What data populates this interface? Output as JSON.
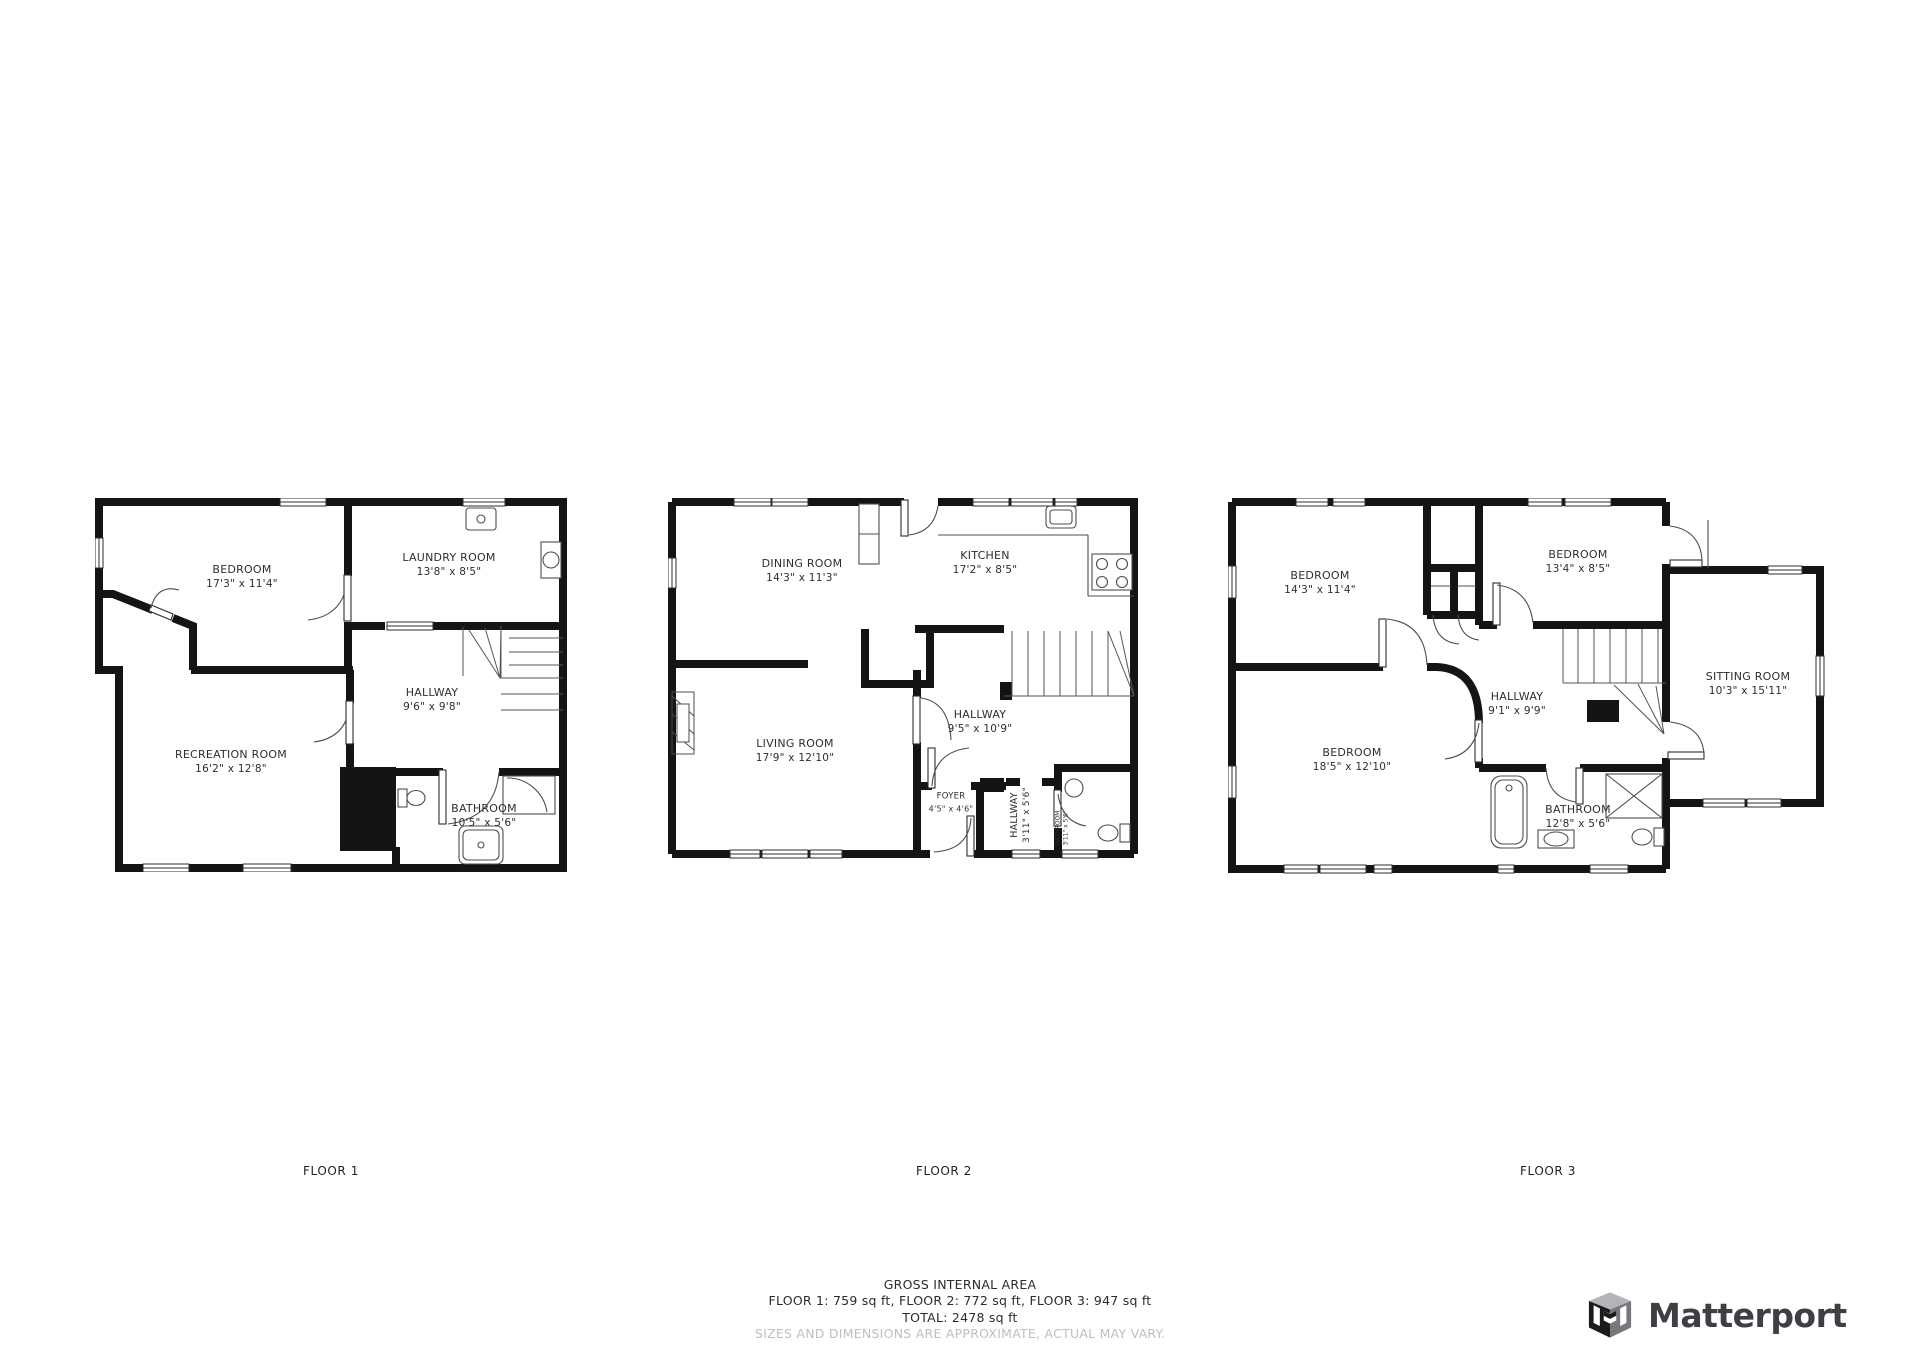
{
  "page": {
    "background": "#ffffff",
    "wall_color": "#141414",
    "label_color": "#2e2e2e",
    "disclaimer_color": "#bfbfbf",
    "brand_color": "#3e3e44"
  },
  "floors": [
    {
      "id": "floor-1",
      "label": "FLOOR 1",
      "caption": {
        "x": 331,
        "y": 1171
      },
      "rooms": [
        {
          "name": "BEDROOM",
          "dims": "17'3\" x 11'4\"",
          "x": 242,
          "y": 577
        },
        {
          "name": "LAUNDRY ROOM",
          "dims": "13'8\" x 8'5\"",
          "x": 449,
          "y": 565
        },
        {
          "name": "HALLWAY",
          "dims": "9'6\" x 9'8\"",
          "x": 432,
          "y": 700
        },
        {
          "name": "RECREATION ROOM",
          "dims": "16'2\" x 12'8\"",
          "x": 231,
          "y": 762
        },
        {
          "name": "BATHROOM",
          "dims": "10'5\" x 5'6\"",
          "x": 484,
          "y": 816
        }
      ]
    },
    {
      "id": "floor-2",
      "label": "FLOOR 2",
      "caption": {
        "x": 944,
        "y": 1171
      },
      "rooms": [
        {
          "name": "DINING ROOM",
          "dims": "14'3\" x 11'3\"",
          "x": 802,
          "y": 571
        },
        {
          "name": "KITCHEN",
          "dims": "17'2\" x 8'5\"",
          "x": 985,
          "y": 563
        },
        {
          "name": "LIVING ROOM",
          "dims": "17'9\" x 12'10\"",
          "x": 795,
          "y": 751
        },
        {
          "name": "HALLWAY",
          "dims": "9'5\" x 10'9\"",
          "x": 980,
          "y": 722
        },
        {
          "name": "FOYER",
          "dims": "4'5\" x 4'6\"",
          "x": 951,
          "y": 803,
          "variant": "small"
        },
        {
          "name": "HALLWAY",
          "dims": "3'11\" x 5'6\"",
          "x": 1021,
          "y": 815,
          "variant": "vertical"
        },
        {
          "name": "BATHROOM",
          "dims": "3'11\" x 5'6\"",
          "x": 1062,
          "y": 828,
          "variant": "vertical-tiny"
        }
      ]
    },
    {
      "id": "floor-3",
      "label": "FLOOR 3",
      "caption": {
        "x": 1548,
        "y": 1171
      },
      "rooms": [
        {
          "name": "BEDROOM",
          "dims": "14'3\" x 11'4\"",
          "x": 1320,
          "y": 583
        },
        {
          "name": "BEDROOM",
          "dims": "13'4\" x 8'5\"",
          "x": 1578,
          "y": 562
        },
        {
          "name": "SITTING ROOM",
          "dims": "10'3\" x 15'11\"",
          "x": 1748,
          "y": 684
        },
        {
          "name": "HALLWAY",
          "dims": "9'1\" x 9'9\"",
          "x": 1517,
          "y": 704
        },
        {
          "name": "BEDROOM",
          "dims": "18'5\" x 12'10\"",
          "x": 1352,
          "y": 760
        },
        {
          "name": "BATHROOM",
          "dims": "12'8\" x 5'6\"",
          "x": 1578,
          "y": 817
        }
      ]
    }
  ],
  "footer": {
    "title": "GROSS INTERNAL AREA",
    "floor_areas": "FLOOR 1: 759 sq ft, FLOOR 2: 772 sq ft, FLOOR 3: 947 sq ft",
    "total": "TOTAL: 2478 sq ft",
    "disclaimer": "SIZES AND DIMENSIONS ARE APPROXIMATE, ACTUAL MAY VARY."
  },
  "branding": {
    "logo_text": "Matterport"
  }
}
